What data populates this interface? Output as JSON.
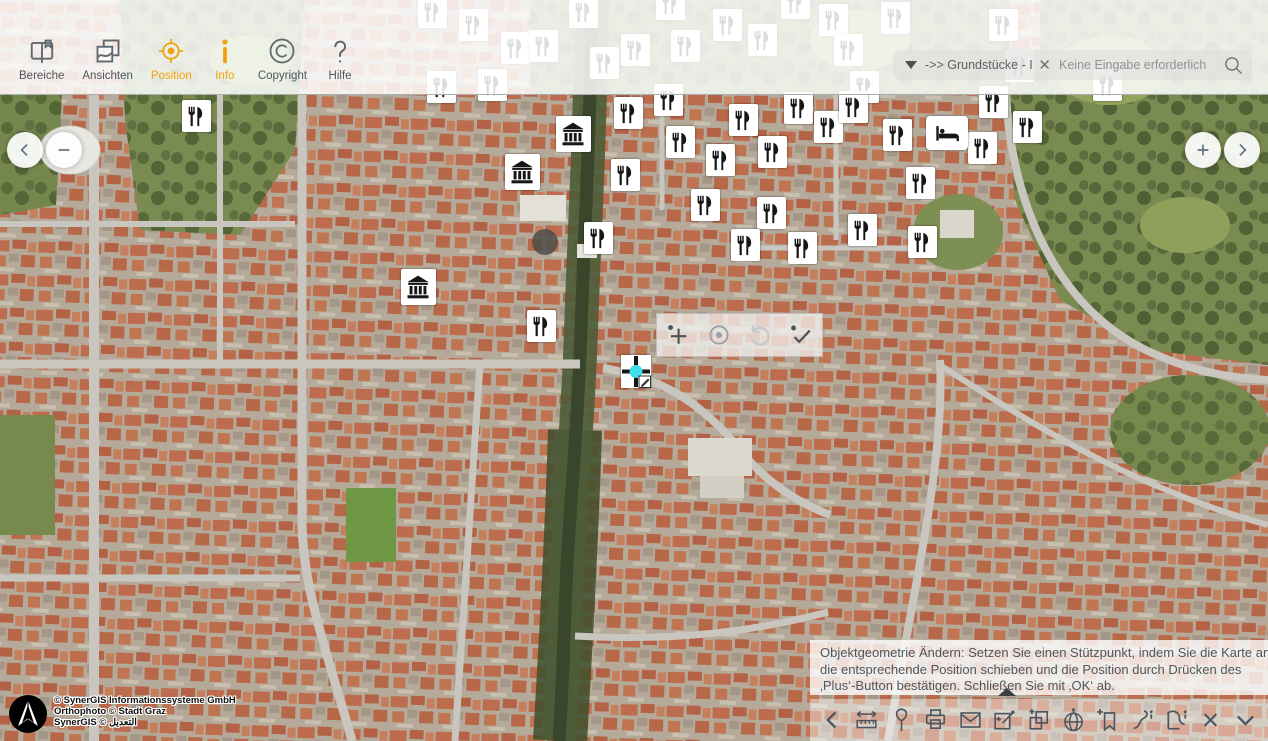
{
  "header": {
    "tools": [
      {
        "label": "Bereiche",
        "active": false
      },
      {
        "label": "Ansichten",
        "active": false
      },
      {
        "label": "Position",
        "active": true
      },
      {
        "label": "Info",
        "active": true
      },
      {
        "label": "Copyright",
        "active": false
      },
      {
        "label": "Hilfe",
        "active": false
      }
    ],
    "accent_color": "#f1a20a",
    "inactive_color": "#4d565c"
  },
  "search": {
    "selected_query": "->> Grundstücke - In",
    "placeholder": "Keine Eingabe erforderlich"
  },
  "nav_buttons": {
    "pan_left": "chevron-left",
    "zoom_out": "minus",
    "zoom_in": "plus",
    "pan_right": "chevron-right"
  },
  "edit_toolbar": {
    "buttons": [
      {
        "name": "add-point",
        "tone": "dark"
      },
      {
        "name": "center-point",
        "tone": "mid"
      },
      {
        "name": "undo",
        "tone": "faint"
      },
      {
        "name": "confirm-ok",
        "tone": "dark"
      }
    ]
  },
  "hint_panel": {
    "lines": [
      "Objektgeometrie Ändern: Setzen Sie einen Stützpunkt, indem Sie die Karte an",
      "die entsprechende Position schieben und die Position durch Drücken des",
      "‚Plus‘-Button bestätigen. Schließen Sie mit ‚OK‘ ab."
    ]
  },
  "bottom_toolbar": {
    "icons": [
      "chevron-left",
      "measure",
      "pin",
      "print",
      "mail",
      "edit-geometry",
      "copy-layers",
      "globe-position",
      "bookmark-add",
      "line-info",
      "area-info",
      "close",
      "chevron-down"
    ]
  },
  "attribution": {
    "lines": [
      "© SynerGIS Informationssysteme GmbH",
      "Orthophoto © Stadt Graz",
      "SynerGIS © التعديل"
    ]
  },
  "map": {
    "city": "Graz",
    "view": "orthophoto",
    "markers": {
      "restaurant": [
        [
          432,
          12
        ],
        [
          473,
          25
        ],
        [
          515,
          48
        ],
        [
          543,
          46
        ],
        [
          583,
          12
        ],
        [
          604,
          63
        ],
        [
          635,
          50
        ],
        [
          670,
          4
        ],
        [
          685,
          46
        ],
        [
          727,
          25
        ],
        [
          762,
          40
        ],
        [
          795,
          3
        ],
        [
          833,
          20
        ],
        [
          848,
          50
        ],
        [
          864,
          87
        ],
        [
          895,
          18
        ],
        [
          1003,
          25
        ],
        [
          1019,
          66
        ],
        [
          1107,
          85
        ],
        [
          196,
          116
        ],
        [
          441,
          87
        ],
        [
          492,
          85
        ],
        [
          628,
          113
        ],
        [
          668,
          100
        ],
        [
          625,
          175
        ],
        [
          680,
          142
        ],
        [
          743,
          120
        ],
        [
          720,
          160
        ],
        [
          772,
          152
        ],
        [
          798,
          108
        ],
        [
          828,
          127
        ],
        [
          853,
          107
        ],
        [
          897,
          135
        ],
        [
          920,
          183
        ],
        [
          982,
          148
        ],
        [
          993,
          102
        ],
        [
          1027,
          127
        ],
        [
          598,
          238
        ],
        [
          705,
          205
        ],
        [
          771,
          213
        ],
        [
          862,
          230
        ],
        [
          922,
          242
        ],
        [
          745,
          245
        ],
        [
          802,
          248
        ],
        [
          541,
          326
        ]
      ],
      "museum": [
        [
          573,
          134
        ],
        [
          522,
          172
        ],
        [
          418,
          287
        ]
      ],
      "hotel": [
        [
          947,
          133
        ]
      ]
    },
    "edit_marker": {
      "x": 636,
      "y": 371
    }
  }
}
